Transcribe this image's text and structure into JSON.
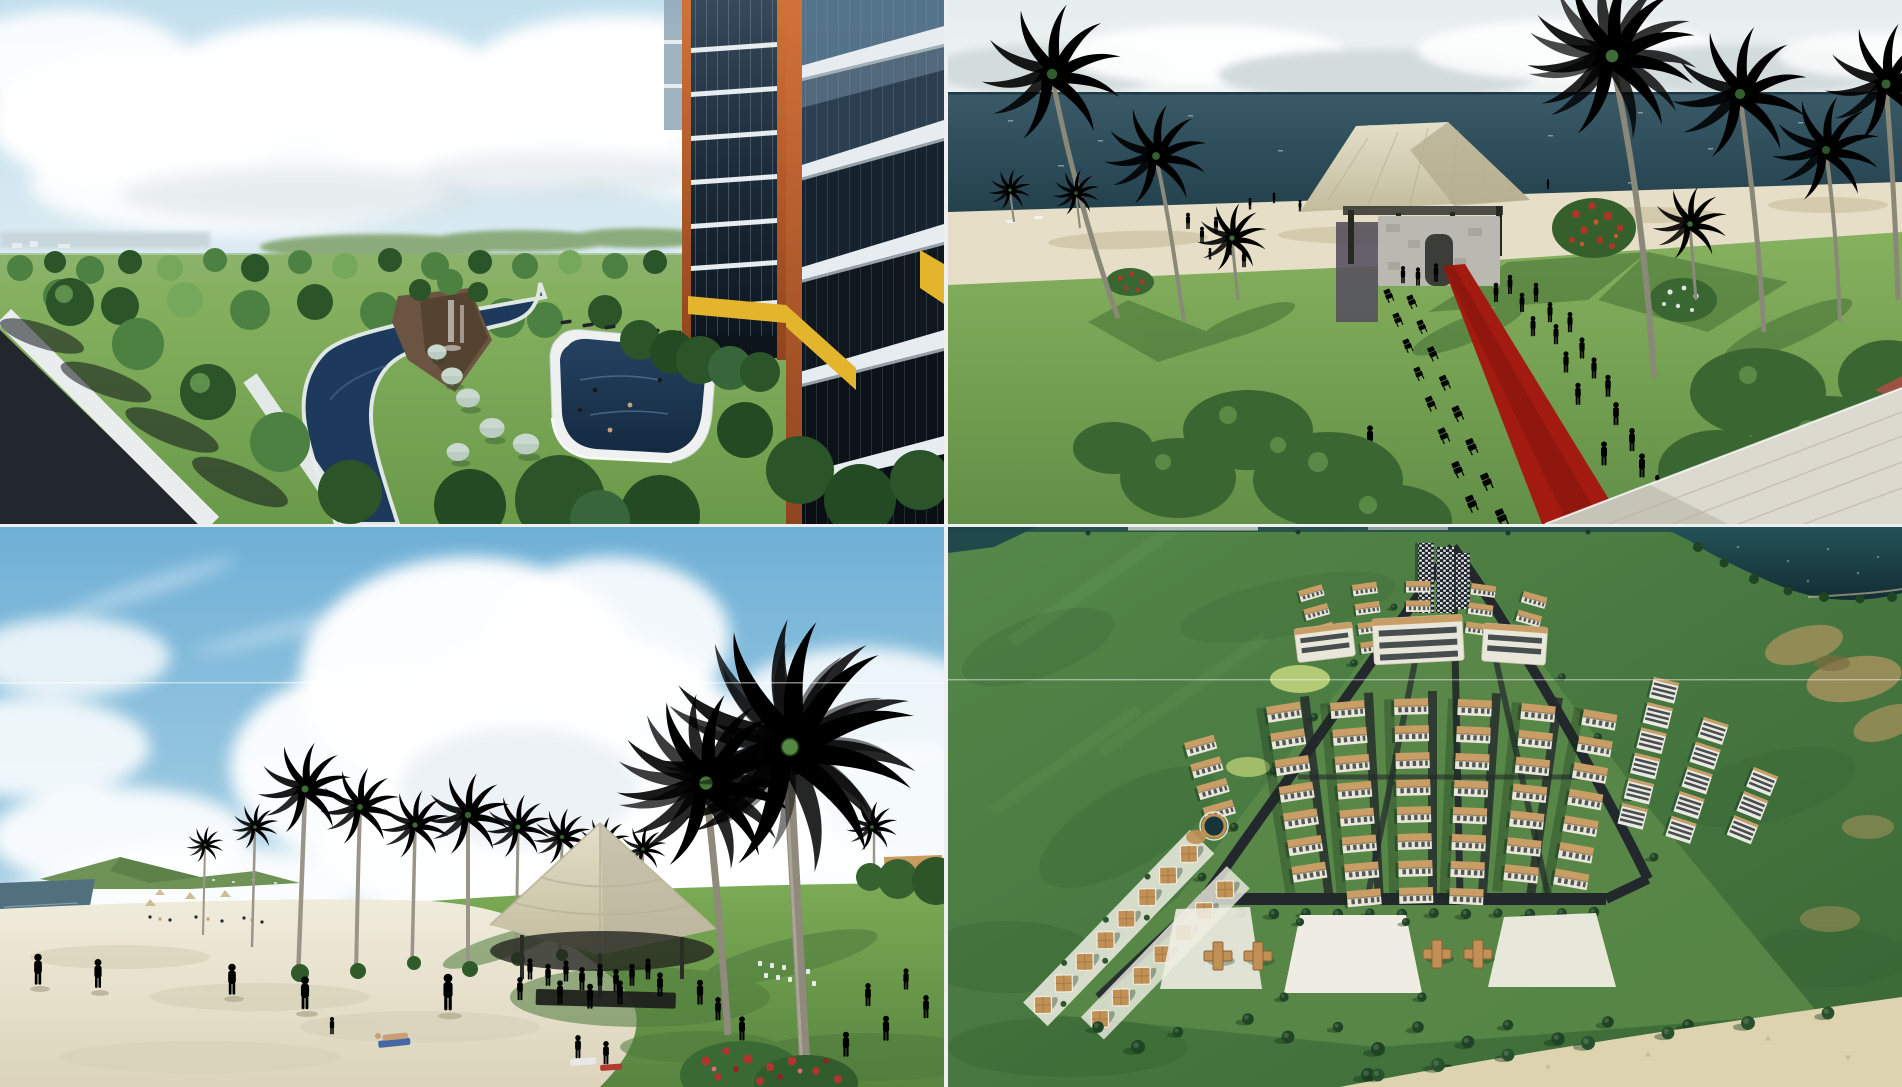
{
  "page": {
    "title": "Beachfront resort project — rendering collage",
    "layout": "2x2 photo collage",
    "text_content": "none — image-only collage"
  },
  "collage": {
    "rows": 2,
    "cols": 2,
    "gutter_px": 4
  },
  "panels": [
    {
      "id": "resort-tower-pool-view",
      "grid_position": "top-left",
      "description": "Elevated view from an orange-framed glass resort tower over a landscaped park: winding dark-blue lagoon with white walkways, rocky waterfall, large swimming pool with white deck and swimmers, sage lawn umbrellas, tree-lined street in the foreground and pale sea on the horizon under a cloudy sky."
    },
    {
      "id": "beach-wedding-ceremony",
      "grid_position": "top-right",
      "description": "Beachfront wedding ceremony: thatched-roof pavilion with stone altar, red carpet aisle flanked by rows of white folding chairs, guests in dark suits and colorful dresses, red and white flowering shrubs, tall palms casting long shadows, white sand beach and dark blue ocean."
    },
    {
      "id": "beach-promenade-gazebo",
      "grid_position": "bottom-left",
      "description": "Palm-lined beach with sunbathers on white sand, a large thatched event gazebo with a crowd and dark stage on the lawn, rows of distant white chairs, a towering foreground palm, red flowering shrubs, ocean glimpse at left and huge cumulus clouds in a blue sky."
    },
    {
      "id": "resort-masterplan-aerial",
      "grid_position": "bottom-right",
      "description": "Aerial view of the wedge-shaped resort master plan: fanned rows of tan-roofed white apartment blocks converging to dark towers, dark tree-lined perimeter roads, diagonal villa chains, white plazas with four cross-shaped pavilions, a round pond, a dark lake at top right and a sand beach corner, all set in green fields."
    }
  ],
  "colors": {
    "gutter": "#eef0ef",
    "p1SkyTop": "#c2dfee",
    "p1SkyLow": "#edf3f4",
    "p1Sea": "#c6d4d9",
    "p1Lawn": "#7cab55",
    "p1LawnDeep": "#699a49",
    "p1Tree": "#4d8142",
    "p1TreeDark": "#2b5429",
    "p1TreeLight": "#76a85c",
    "p1Road": "#22272d",
    "p1Sidewalk": "#e9edee",
    "p1Water": "#1d3a5c",
    "p1Rock": "#6b5442",
    "p1Deck": "#eef1f0",
    "p1Umbrella": "#b9cdc0",
    "p1Orange": "#c4632e",
    "p1OrangeDark": "#8f451e",
    "p1Glass": "#1b2631",
    "p1Slab": "#e6ecf0",
    "p1Yellow": "#e3b52c",
    "p2Sky": "#eef2f2",
    "p2Sea": "#2b4a57",
    "p2Sand": "#e6dec6",
    "p2Lawn": "#7aa854",
    "p2Thatch": "#d8d2b4",
    "p2Stone": "#b9b9b1",
    "p2Carpet": "#a31b10",
    "p2Chair": "#f0f2f0",
    "p2Suit": "#1e2126",
    "p2Palm": "#33602e",
    "p2Trunk": "#8a8878",
    "p2Bush": "#3a6632",
    "p2FlowerRed": "#b03428",
    "p2RoofCorner": "#dcd9cf",
    "p2Tile": "#9a5340",
    "p3SkyTop": "#6fb0d6",
    "p3SkyLow": "#d9e9ef",
    "p3Sea": "#50707e",
    "p3Sand": "#ece7d4",
    "p3Lawn": "#74a24f",
    "p3Palm": "#3c6d33",
    "p3Trunk": "#9a9588",
    "p3Thatch": "#dcd8c2",
    "p3Crowd": "#23262a",
    "p3Flower": "#b23430",
    "p4Field": "#47793f",
    "p4Lake": "#1c464b",
    "p4Road": "#23282c",
    "p4Roof": "#c89e66",
    "p4Facade": "#e9e7da",
    "p4Tree": "#1f4423",
    "p4Plaza": "#efede3",
    "p4Villa": "#c09055",
    "p4Beach": "#ddd3ae",
    "p4Dry": "#9f8f5a",
    "p4Tower": "#1d2328",
    "p4GrassIn": "#5b8a49"
  }
}
